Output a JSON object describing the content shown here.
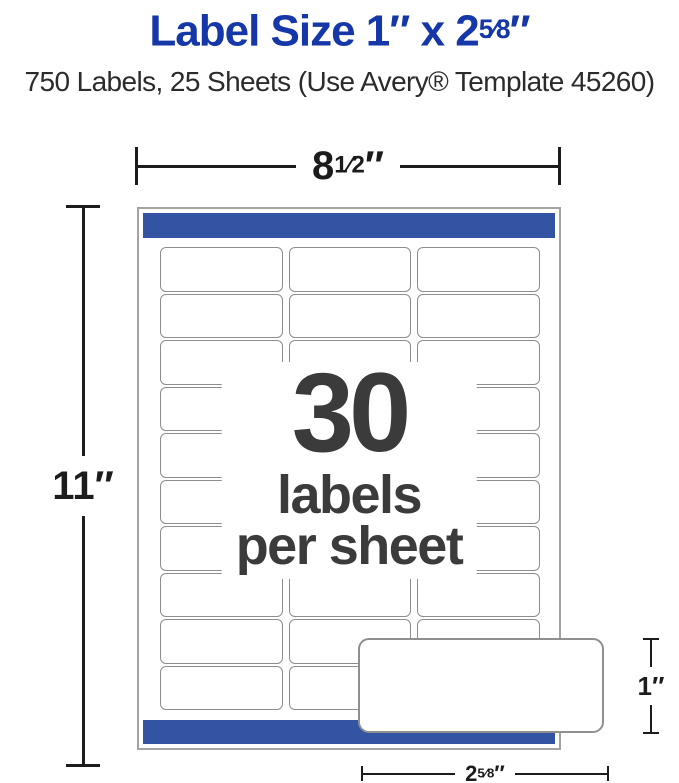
{
  "header": {
    "title_pre": "Label Size 1″ x 2",
    "title_frac": "5⁄8",
    "title_suf": "″",
    "subtitle": "750 Labels, 25 Sheets (Use Avery® Template 45260)"
  },
  "dims": {
    "sheet_width_pre": "8",
    "sheet_width_frac": "1⁄2",
    "sheet_width_suf": "″",
    "sheet_height": "11″",
    "label_height": "1″",
    "label_width_pre": "2",
    "label_width_frac": "5⁄8",
    "label_width_suf": "″"
  },
  "sheet": {
    "count": "30",
    "count_caption_line1": "labels",
    "count_caption_line2": "per sheet",
    "columns": 3,
    "rows": 10
  },
  "colors": {
    "title_blue": "#1637a8",
    "band_blue": "#3254a3",
    "dimension_black": "#1c1c1c",
    "center_text_gray": "#3b3b3b",
    "label_border_gray": "#8d8d8d"
  }
}
